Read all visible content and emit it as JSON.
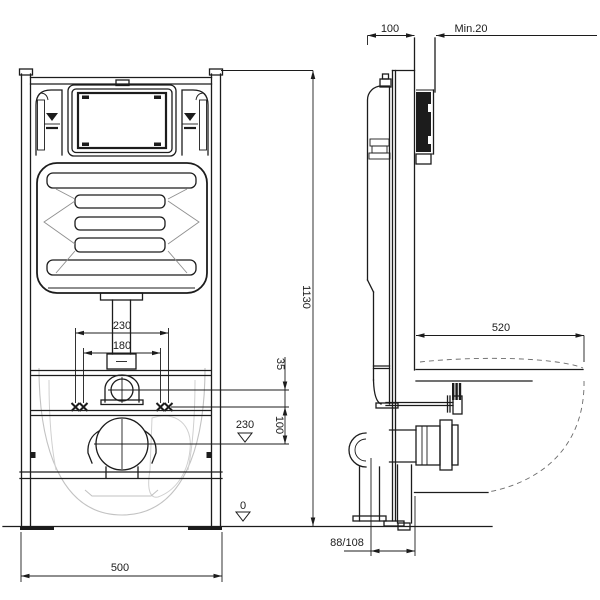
{
  "colors": {
    "background": "#ffffff",
    "line": "#1c1c1c",
    "faint_outline": "#c2c2c2",
    "flush_plate_fill": "#1c1c1c"
  },
  "drawing": {
    "type": "technical-installation-drawing",
    "subject": "wall-hung-wc-mounting-frame-with-concealed-cistern",
    "views": {
      "left": "front-elevation",
      "right": "side-elevation"
    }
  },
  "dims": {
    "frame_depth": "100",
    "min_cover": "Min.20",
    "frame_height": "1130",
    "pan_depth": "520",
    "fixing_outer": "230",
    "fixing_inner": "180",
    "supply_to_fixing": "35",
    "outlet_height_datum": "230",
    "fixing_to_outlet": "100",
    "floor_level": "0",
    "frame_width": "500",
    "outlet_offset": "88/108"
  }
}
